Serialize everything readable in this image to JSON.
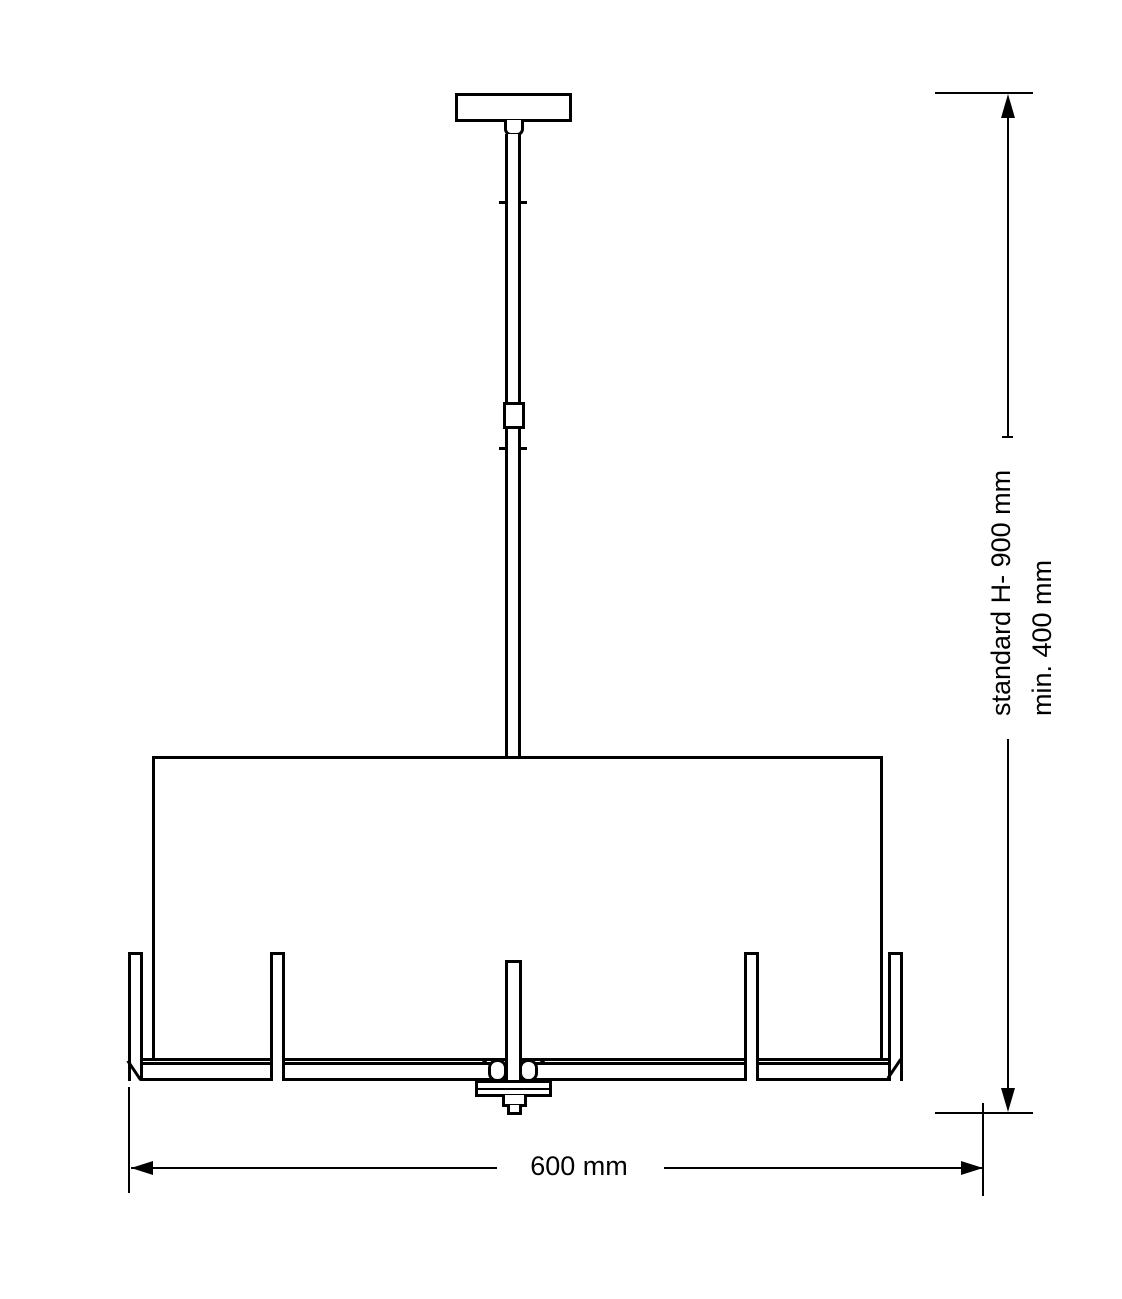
{
  "labels": {
    "height_standard": "standard H- 900 mm",
    "height_min": "min. 400 mm",
    "width": "600 mm"
  },
  "colors": {
    "line": "#000000",
    "background": "#ffffff"
  }
}
